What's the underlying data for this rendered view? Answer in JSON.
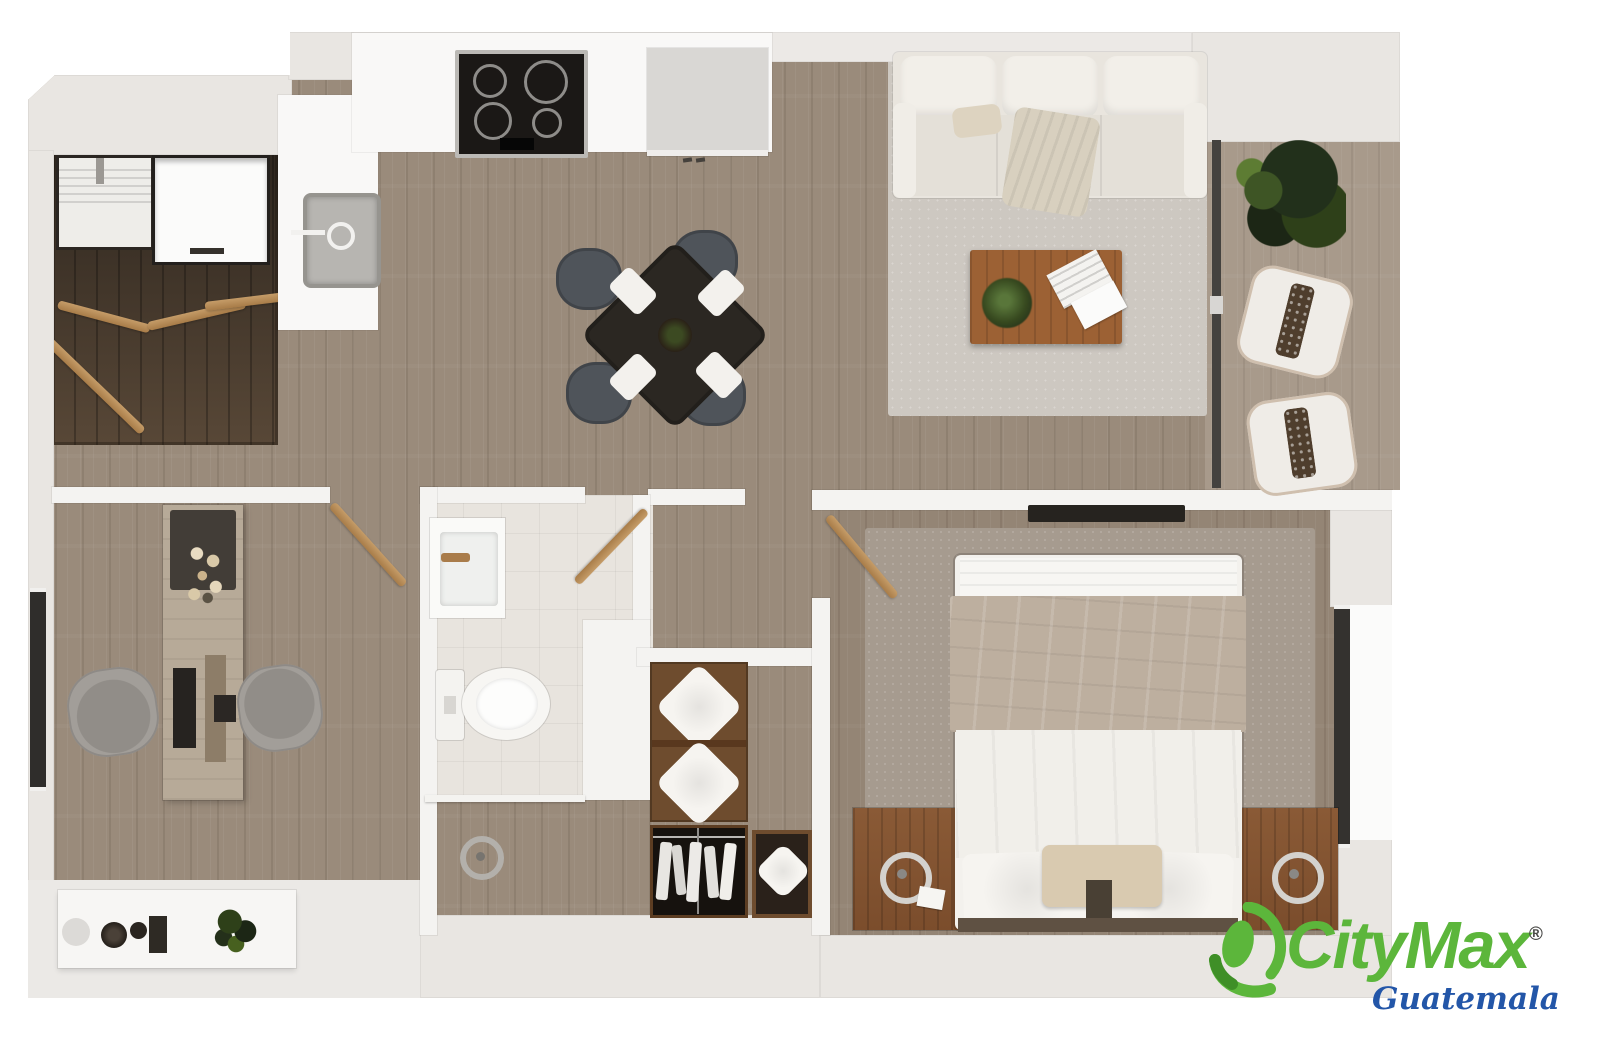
{
  "meta": {
    "type": "apartment-floor-plan",
    "view": "top-down-3d-render",
    "units": "1-bedroom-plus-office-2-bath-layout"
  },
  "logo": {
    "brand": "CityMax",
    "registered": "®",
    "region": "Guatemala",
    "brand_color": "#5cb63b",
    "region_color": "#2356a8"
  },
  "palette": {
    "background": "#ffffff",
    "wall_gray": "#e9e6e2",
    "wall_white": "#f4f3f1",
    "floor_wood": "#9a8b7b",
    "floor_dark_closet": "#473b2f",
    "floor_tile": "#e8e4de",
    "rug_living": "#cdc8c1",
    "rug_bedroom": "#a69b8f",
    "furniture_wood": "#8a5a36",
    "sofa_cream": "#eae6df",
    "table_dark": "#2b2722",
    "accent_green_plant": "#2e4019"
  },
  "rooms": {
    "laundry_pantry": {
      "items": [
        "washer",
        "refrigerator",
        "folding-doors"
      ]
    },
    "kitchen": {
      "items": [
        "cooktop-4-burners",
        "counter",
        "sink",
        "island-cabinet"
      ]
    },
    "dining_area": {
      "items": [
        "square-dark-table",
        "four-chairs",
        "four-place-settings",
        "centerpiece"
      ]
    },
    "living_room": {
      "items": [
        "three-seat-sofa",
        "throw-blanket",
        "area-rug",
        "coffee-table",
        "potted-plant",
        "magazine"
      ]
    },
    "balcony": {
      "items": [
        "large-plant",
        "armchair",
        "armchair",
        "sliding-glass-door"
      ]
    },
    "home_office": {
      "items": [
        "desk",
        "monitor",
        "keyboard",
        "flowers",
        "office-chair",
        "office-chair",
        "window",
        "sideboard",
        "bowls",
        "plant",
        "door"
      ]
    },
    "bathroom": {
      "items": [
        "vanity-sink",
        "toilet",
        "door",
        "shower",
        "floor-drain"
      ]
    },
    "closet": {
      "items": [
        "shelving-with-pillows",
        "hanging-clothes",
        "pillow-shelf"
      ]
    },
    "bedroom": {
      "items": [
        "double-bed",
        "pillows",
        "accent-pillow",
        "blanket",
        "nightstand-left",
        "nightstand-right",
        "lamps",
        "area-rug",
        "wall-tv",
        "window",
        "door"
      ]
    }
  }
}
